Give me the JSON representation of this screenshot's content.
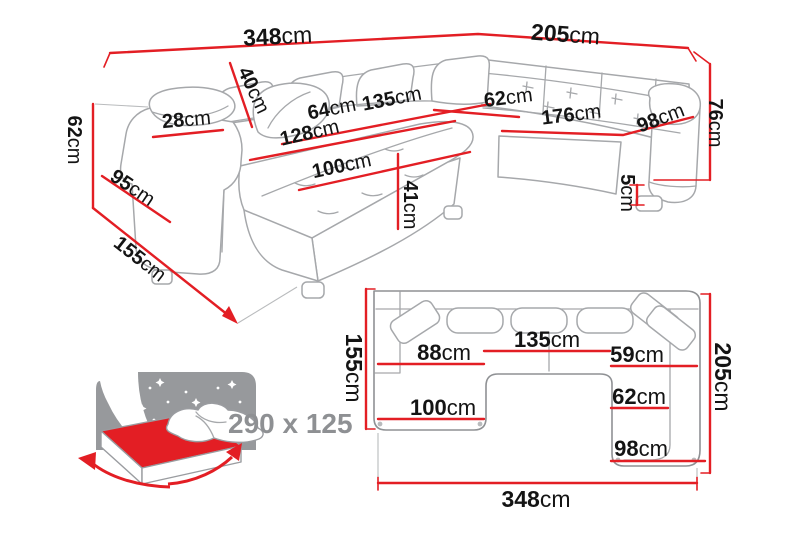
{
  "diagram_title": "corner-sofa-dimensions",
  "colors": {
    "dimension_red": "#e31e24",
    "label_black": "#141414",
    "lineart_gray": "#a6a8ab",
    "grid_gray": "#c6c8ca",
    "bed_icon_gray": "#97999c",
    "size_label_gray": "#8e9093",
    "background": "#ffffff"
  },
  "perspective": {
    "d348": {
      "v": "348",
      "u": "cm"
    },
    "d205": {
      "v": "205",
      "u": "cm"
    },
    "d76": {
      "v": "76",
      "u": "cm"
    },
    "d62l": {
      "v": "62",
      "u": "cm"
    },
    "d155": {
      "v": "155",
      "u": "cm"
    },
    "d95": {
      "v": "95",
      "u": "cm"
    },
    "d28": {
      "v": "28",
      "u": "cm"
    },
    "d40": {
      "v": "40",
      "u": "cm"
    },
    "d64": {
      "v": "64",
      "u": "cm"
    },
    "d135": {
      "v": "135",
      "u": "cm"
    },
    "d128": {
      "v": "128",
      "u": "cm"
    },
    "d100": {
      "v": "100",
      "u": "cm"
    },
    "d41": {
      "v": "41",
      "u": "cm"
    },
    "d62r": {
      "v": "62",
      "u": "cm"
    },
    "d176": {
      "v": "176",
      "u": "cm"
    },
    "d98": {
      "v": "98",
      "u": "cm"
    },
    "d5": {
      "v": "5",
      "u": "cm"
    }
  },
  "plan": {
    "d155": {
      "v": "155",
      "u": "cm"
    },
    "d205": {
      "v": "205",
      "u": "cm"
    },
    "d348": {
      "v": "348",
      "u": "cm"
    },
    "d88": {
      "v": "88",
      "u": "cm"
    },
    "d135": {
      "v": "135",
      "u": "cm"
    },
    "d59": {
      "v": "59",
      "u": "cm"
    },
    "d100": {
      "v": "100",
      "u": "cm"
    },
    "d62": {
      "v": "62",
      "u": "cm"
    },
    "d98": {
      "v": "98",
      "u": "cm"
    }
  },
  "bed": {
    "size": "290 x 125"
  }
}
